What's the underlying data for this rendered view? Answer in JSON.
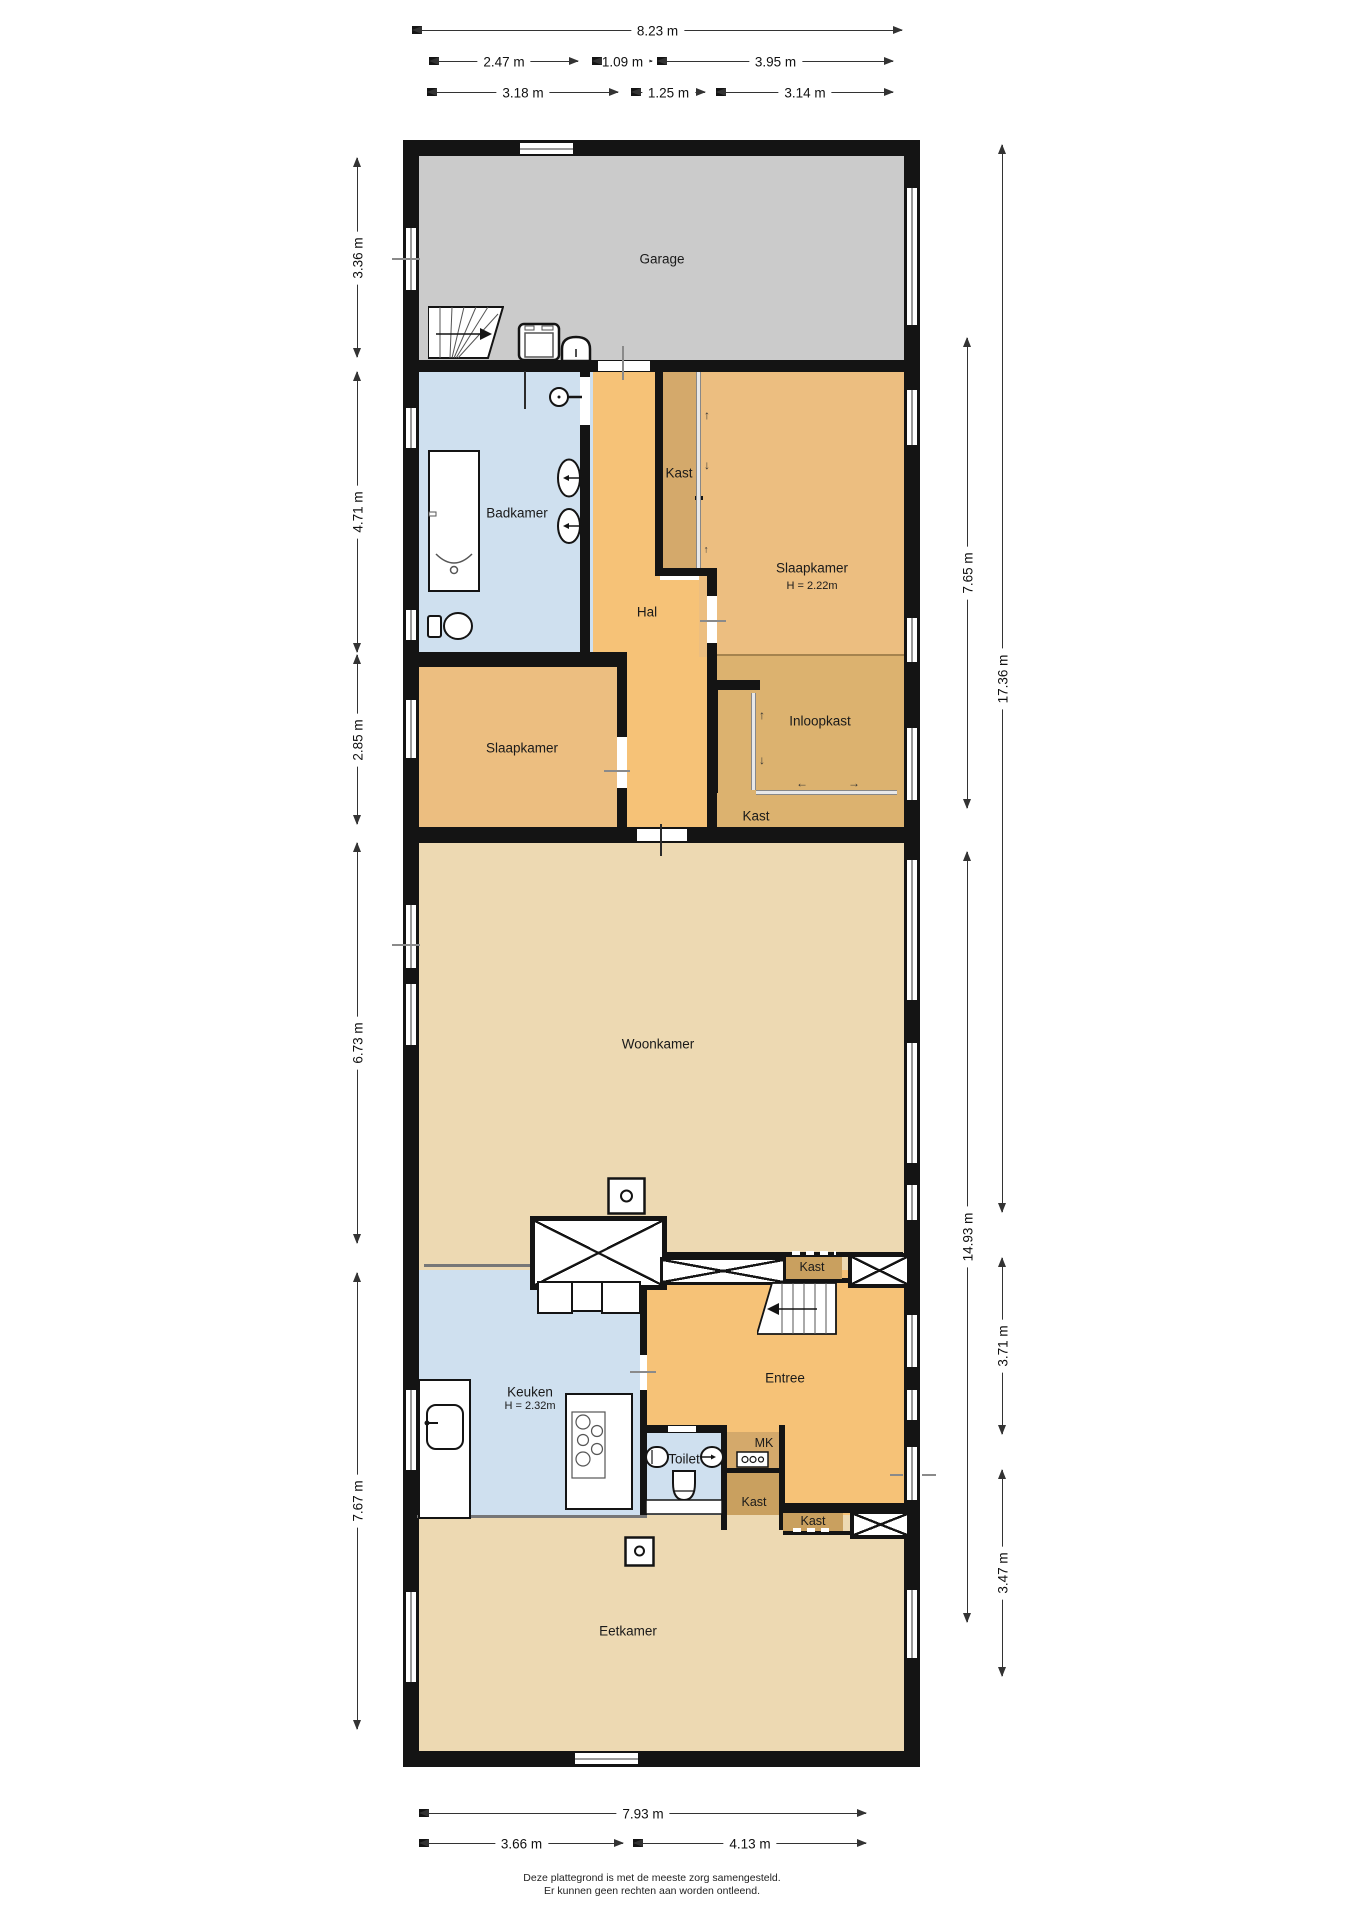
{
  "rooms": {
    "garage": "Garage",
    "badkamer": "Badkamer",
    "hal": "Hal",
    "kast_strip": "Kast",
    "slaapkamer_right": "Slaapkamer",
    "slaapkamer_right_height": "H = 2.22m",
    "slaapkamer_left": "Slaapkamer",
    "inloopkast": "Inloopkast",
    "kast_inloop": "Kast",
    "woonkamer": "Woonkamer",
    "keuken": "Keuken",
    "keuken_height": "H = 2.32m",
    "entree": "Entree",
    "toilet": "Toilet",
    "mk": "MK",
    "kast_row": "Kast",
    "kast_center": "Kast",
    "kast_right": "Kast",
    "eetkamer": "Eetkamer"
  },
  "dims": {
    "top_total": "8.23 m",
    "top_a": "2.47 m",
    "top_b": "1.09 m",
    "top_c": "3.95 m",
    "top_d": "3.18 m",
    "top_e": "1.25 m",
    "top_f": "3.14 m",
    "left_a": "3.36 m",
    "left_b": "4.71 m",
    "left_c": "2.85 m",
    "left_d": "6.73 m",
    "left_e": "7.67 m",
    "right_inner_a": "7.65 m",
    "right_inner_b": "14.93 m",
    "right_outer_a": "17.36 m",
    "right_outer_b": "3.71 m",
    "right_outer_c": "3.47 m",
    "bottom_total": "7.93 m",
    "bottom_a": "3.66 m",
    "bottom_b": "4.13 m"
  },
  "icons": {
    "arrow_up": "↑",
    "arrow_down": "↓",
    "arrow_left": "←",
    "arrow_right": "→"
  },
  "footer": {
    "line1": "Deze plattegrond is met de meeste zorg samengesteld.",
    "line2": "Er kunnen geen rechten aan worden ontleend."
  },
  "colors": {
    "wall": "#141414",
    "garage": "#cbcbcb",
    "wet_room_blue": "#cfe0ef",
    "hall_orange": "#f6c277",
    "bedroom_orange": "#ecbe80",
    "closet_tan": "#dcb26f",
    "closet_dark_tan": "#d4a96b",
    "cabinet_tan": "#c9a05f",
    "living_beige": "#edd9b2"
  }
}
